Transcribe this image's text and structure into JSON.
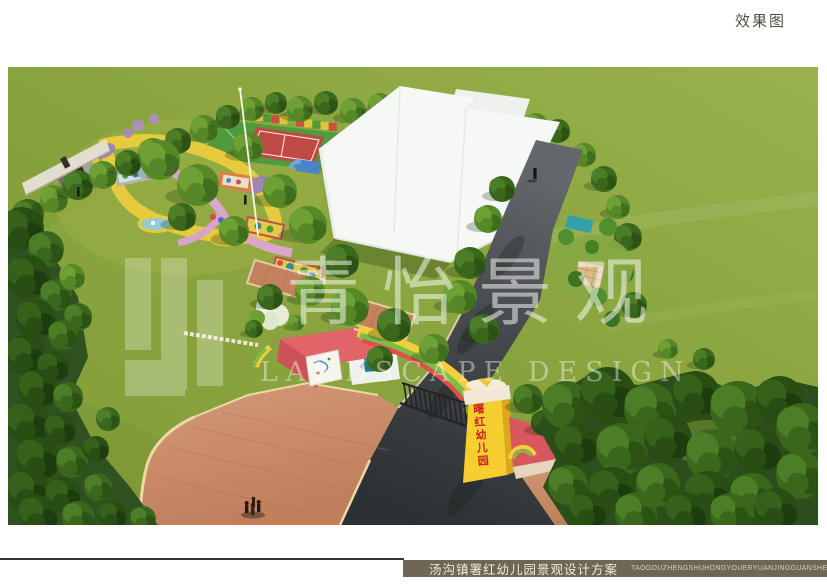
{
  "page": {
    "label_top_right": "效果图"
  },
  "watermark": {
    "cn": "青怡景观",
    "en": "LANDSCAPE DESIGN"
  },
  "gate": {
    "pillar_text": "曙红幼儿园"
  },
  "footer": {
    "title_cn": "汤沟镇署红幼儿园景观设计方案",
    "title_pinyin": "TAOGOUZHENGSHUHONGYOUERYUANJINGGUANSHEJIFANGAN"
  },
  "palette": {
    "grass_light": "#96b14c",
    "grass_dark": "#7a9634",
    "road_light": "#63676b",
    "road_dark": "#2d3033",
    "brick": "#c98a67",
    "curb_cream": "#ecd9a4",
    "building_white": "#f6f8f5",
    "gate_pink": "#e06468",
    "pillar_yellow": "#f6ce2f",
    "rainbow": [
      "#f2cf39",
      "#7cbd48",
      "#e05048"
    ],
    "sign_red": "#ce2023",
    "footer_bar": "#6e6757",
    "label_color": "#534d40",
    "tree_dark": "#2c4e1c",
    "tree_light": "#719d36"
  }
}
